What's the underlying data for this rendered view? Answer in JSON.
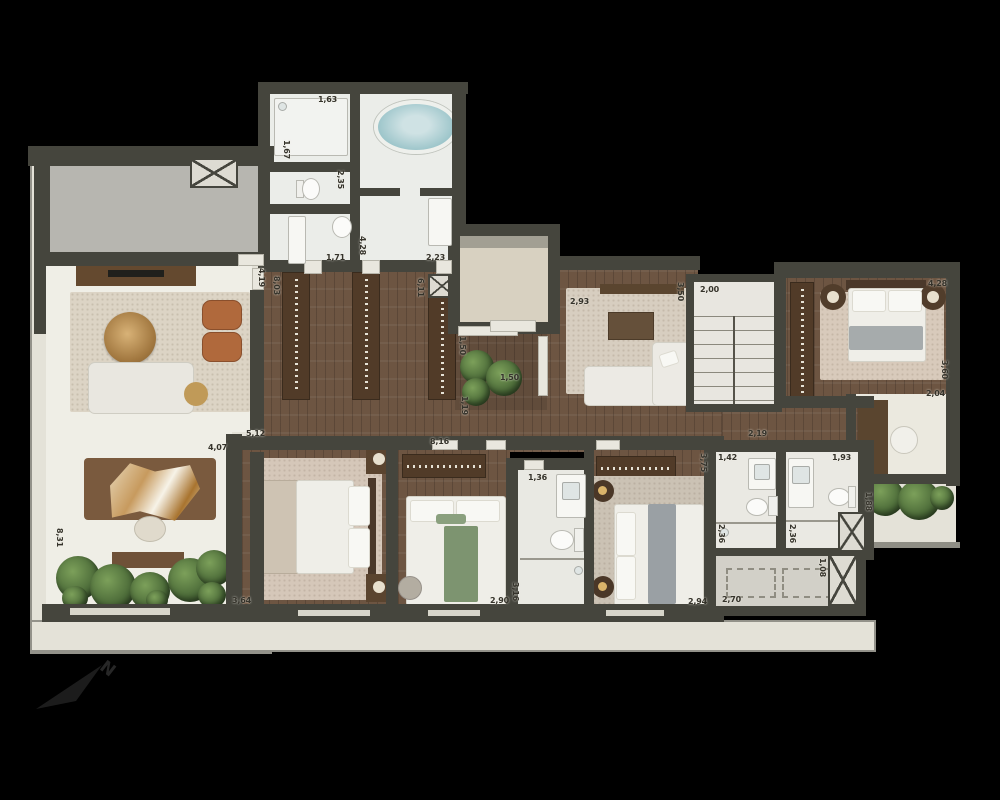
{
  "compass": {
    "label": "N"
  },
  "palette": {
    "background": "#000000",
    "wall": "#45453d",
    "wood_floor": "#6d5542",
    "tile_floor": "#ebede9",
    "terrace_floor": "#e4e2d8",
    "entry_floor": "#b7b6b0",
    "rug": "#d8cabb",
    "bathtub_water": "#a9ccd1",
    "plant_green": "#4f6b3a",
    "armchair_leather": "#b0693c",
    "stair_floor": "#e8e6e0"
  },
  "dims": {
    "bath_shower_room_width": "1,63",
    "bath_shower_room_depth": "1,67",
    "bath_wc_depth": "2,35",
    "bath_suite_depth": "4,28",
    "bath_vanity_width": "1,71",
    "bath_suite_width": "2,23",
    "entry_side_depth": "4,19",
    "closet_hall_depth": "8,03",
    "closet_rail_depth": "6,11",
    "patio_depth": "1,50",
    "patio_width": "1,50",
    "patio_passage_depth": "1,19",
    "hallway_length": "8,16",
    "tv_room_width": "2,93",
    "stairs_width": "2,00",
    "stairs_side_depth": "3,50",
    "stairs_passage_width": "2,19",
    "suite2_width": "4,28",
    "suite2_depth": "3,60",
    "study_width": "2,04",
    "bath_right_width": "1,93",
    "bath_left_width": "1,42",
    "bath_left_depth": "2,36",
    "bath_right_depth": "2,36",
    "laundry_width": "2,70",
    "laundry_shaft_depth": "1,08",
    "side_terrace_depth": "1,88",
    "master_bed_width": "5,12",
    "terrace_dining_width": "4,07",
    "terrace_depth": "8,31",
    "terrace_walk_width": "3,64",
    "bedroom2_width": "2,90",
    "bath_mid_depth": "3,16",
    "bedroom3_width": "2,94",
    "bedroom3_depth": "3,75",
    "bath_mid_width": "1,36"
  }
}
